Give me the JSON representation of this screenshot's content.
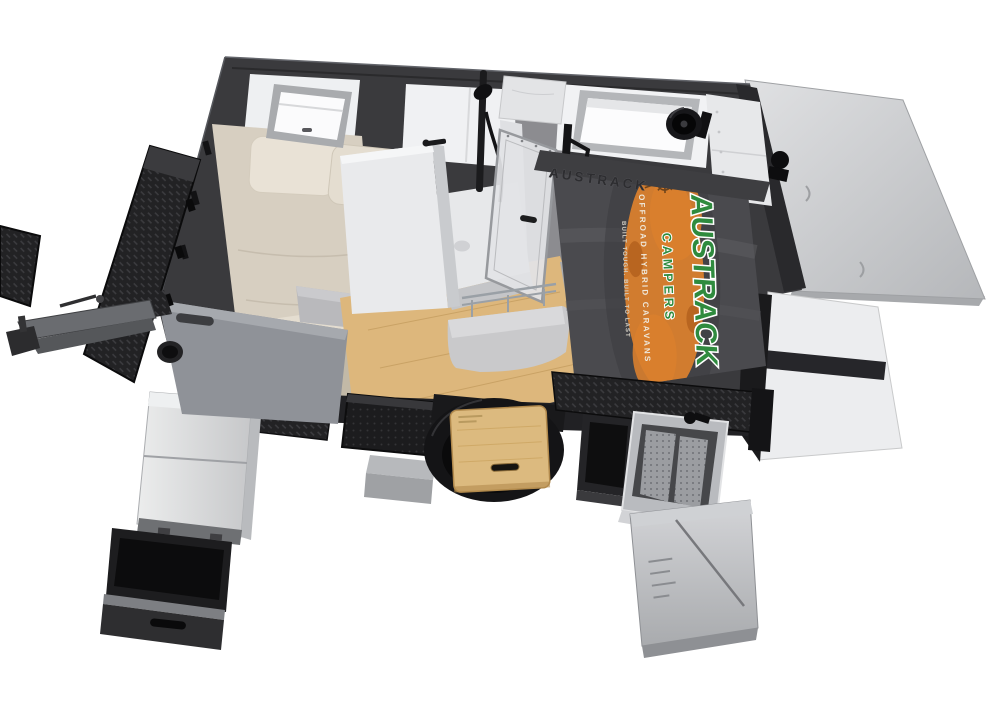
{
  "meta": {
    "description": "3D cutaway studio render of an Austrack Campers off-road hybrid caravan seen from above the front-left corner, with the pop-top roof panel raised, the interior bed and ensuite shower exposed, and the slide-out fridge, storage drawers, fold-out table over the spare wheel, entry step and stainless slide-out kitchen all deployed. Pure white background.",
    "background": "#ffffff"
  },
  "branding": {
    "wordmark": "AUSTRACK",
    "wordmark_sub": "CAMPERS",
    "tagline": "OFFROAD HYBRID CARAVANS",
    "slogan": "BUILT TOUGH. BUILT TO LAST",
    "rail_embossed": "AUSTRACK",
    "colors": {
      "green": "#2f8b3e",
      "orange": "#d97f2e",
      "orange_deep": "#b25f1d",
      "cream": "#efe9dc",
      "cream_dim": "#d6d1c5"
    }
  },
  "scene": {
    "colors": {
      "shell": "#3a3a3d",
      "tonneau": "#4a4a4e",
      "bed": "#d7cfc1",
      "floor": "#ddb77c",
      "rear_panel": "#cdcfd2",
      "wall_white": "#ecedef",
      "gunmetal": "#8f9298",
      "steel": "#bcbec2",
      "checkerplate": "#222224"
    }
  }
}
